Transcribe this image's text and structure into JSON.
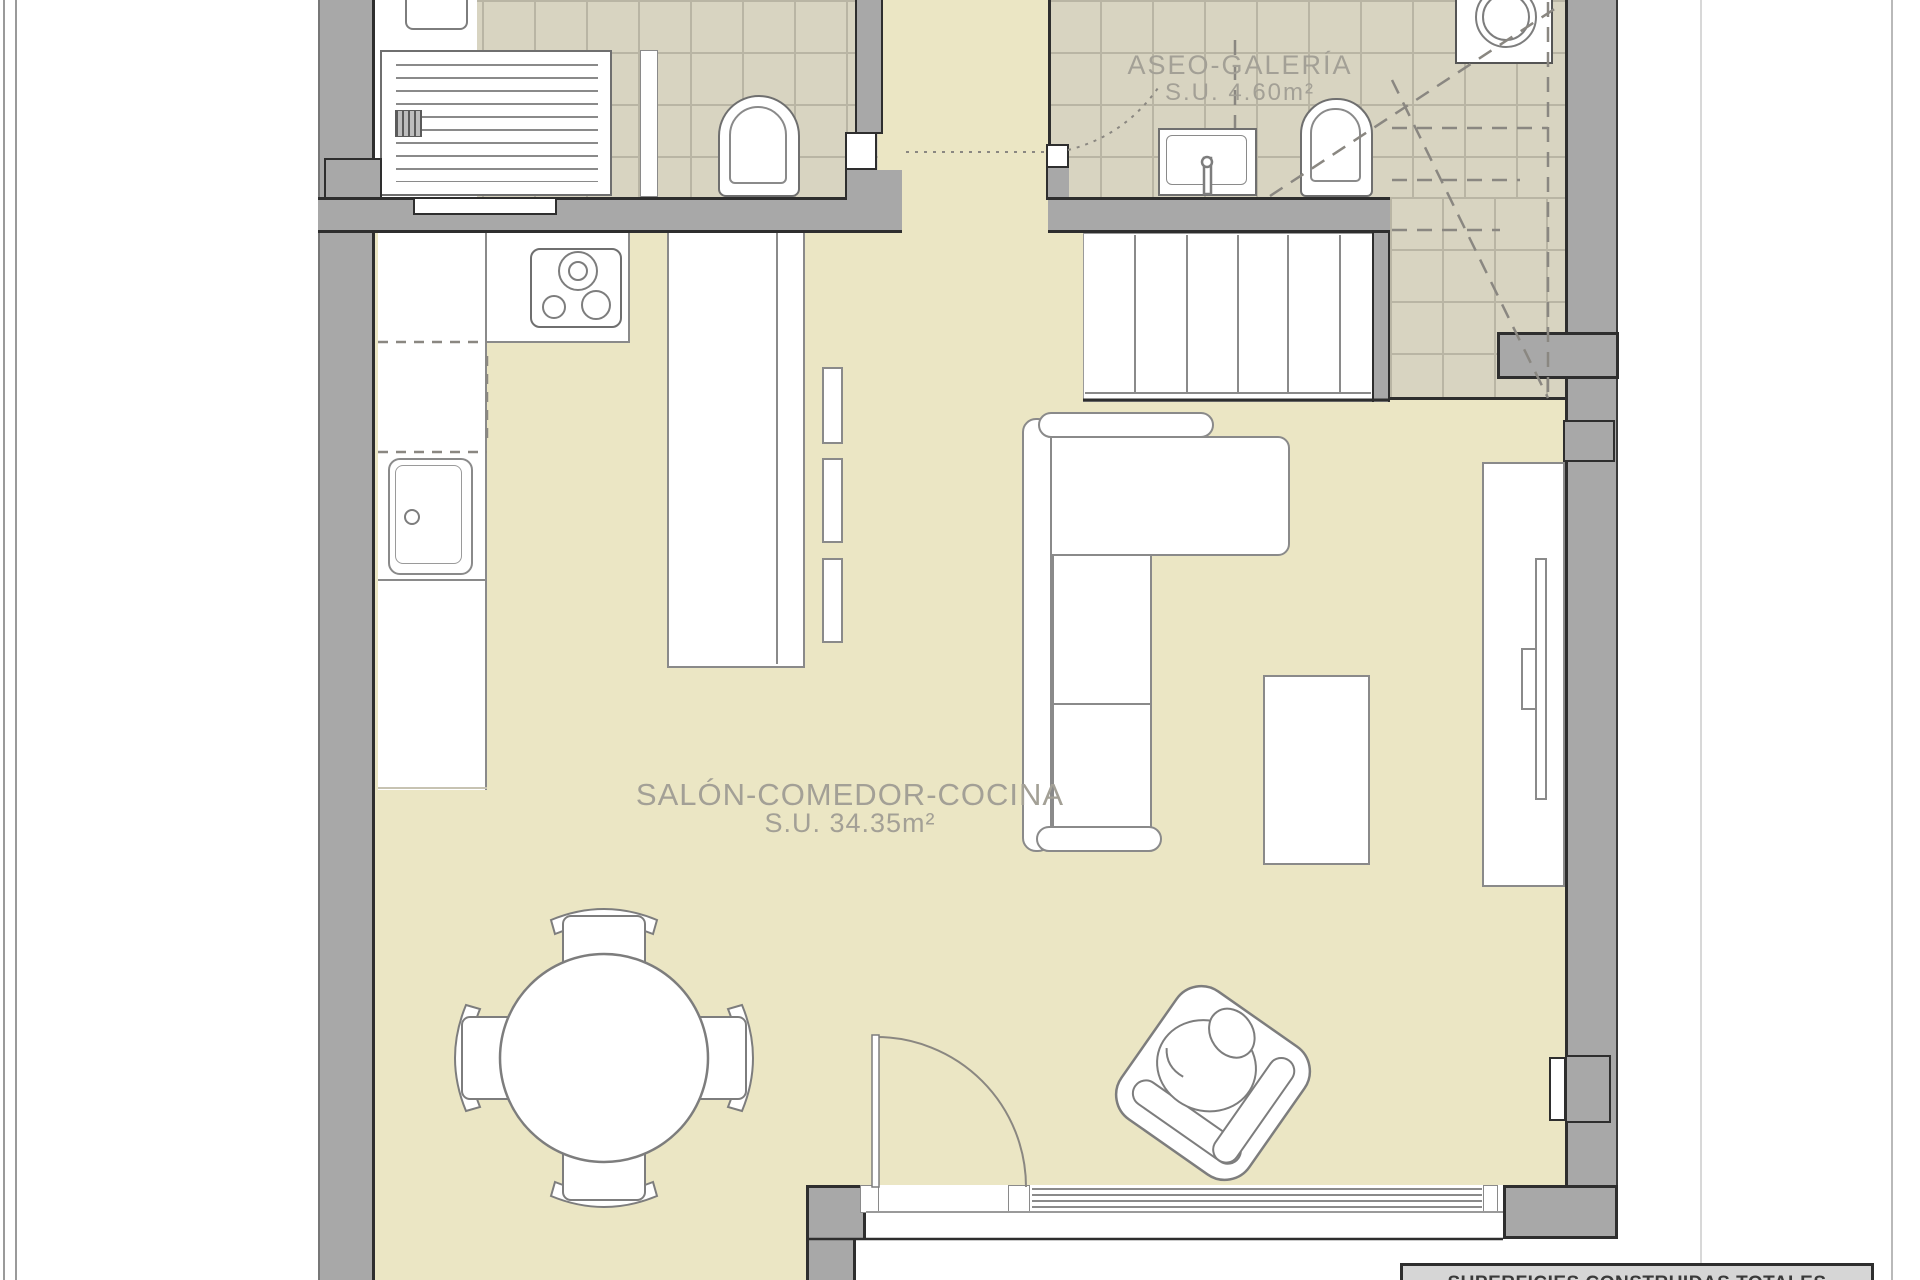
{
  "plan": {
    "type": "floor-plan",
    "rooms": {
      "salon": {
        "name": "SALÓN-COMEDOR-COCINA",
        "area": "S.U. 34.35m²"
      },
      "aseo": {
        "name": "ASEO-GALERÍA",
        "area": "S.U. 4.60m²"
      }
    },
    "furniture": [
      "shower-tray",
      "toilet",
      "washing-machine",
      "bathroom-sink",
      "hob",
      "kitchen-sink",
      "kitchen-peninsula",
      "stairs",
      "sofa-l-shaped",
      "coffee-table",
      "tv-unit",
      "round-dining-table",
      "dining-chairs",
      "armchair",
      "entrance-door",
      "window"
    ]
  },
  "summary": {
    "title": "SUPERFICIES CONSTRUIDAS TOTALES"
  },
  "colors": {
    "floor": "#ebe6c4",
    "tile": "#d8d4c1",
    "tile_line": "#b9b5a4",
    "wall": "#a8a8a8",
    "wall_dark": "#2e2e2e",
    "furniture_line": "#7d7d7d",
    "annotation": "#8a8781",
    "label_text": "#a3a096",
    "summary_bg": "#d6d6d6",
    "summary_text": "#3a3a3a"
  }
}
